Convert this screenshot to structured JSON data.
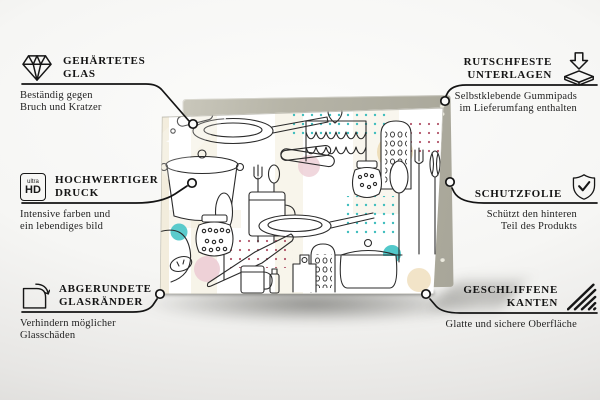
{
  "canvas": {
    "width": 600,
    "height": 400
  },
  "colors": {
    "background_top": "#fbfbfa",
    "background_edge": "#d8d7d4",
    "text": "#141414",
    "connector_line": "#141414",
    "backing_board": "#b4b2a7",
    "glass_background": "#ffffff",
    "doodle_line": "#2b2b2b",
    "accent_teal": "#49c5c7",
    "accent_pink": "#eccdd5",
    "accent_yellow": "#f8f3c9",
    "accent_tan": "#ecd9b0",
    "dot_teal": "#3fbdbd",
    "dot_maroon": "#b2556a"
  },
  "product": {
    "pattern": "kitchen-utensils-doodles"
  },
  "features_left": [
    {
      "icon": "diamond-icon",
      "title_line1": "GEHÄRTETES",
      "title_line2": "GLAS",
      "desc_line1": "Beständig gegen",
      "desc_line2": "Bruch und Kratzer"
    },
    {
      "icon": "ultra-hd-icon",
      "icon_label_small": "ultra",
      "icon_label_big": "HD",
      "title_line1": "HOCHWERTIGER",
      "title_line2": "DRUCK",
      "desc_line1": "Intensive farben und",
      "desc_line2": "ein lebendiges bild"
    },
    {
      "icon": "rounded-corner-icon",
      "title_line1": "ABGERUNDETE",
      "title_line2": "GLASRÄNDER",
      "desc_line1": "Verhindern möglicher",
      "desc_line2": "Glasschäden"
    }
  ],
  "features_right": [
    {
      "icon": "rubber-pads-icon",
      "title_line1": "RUTSCHFESTE",
      "title_line2": "UNTERLAGEN",
      "desc_line1": "Selbstklebende Gummipads",
      "desc_line2": "im Lieferumfang enthalten"
    },
    {
      "icon": "shield-check-icon",
      "title_line1": "SCHUTZFOLIE",
      "title_line2": "",
      "desc_line1": "Schützt den hinteren",
      "desc_line2": "Teil des Produkts"
    },
    {
      "icon": "ground-edges-icon",
      "title_line1": "GESCHLIFFENE",
      "title_line2": "KANTEN",
      "desc_line1": "Glatte und sichere Oberfläche",
      "desc_line2": ""
    }
  ]
}
